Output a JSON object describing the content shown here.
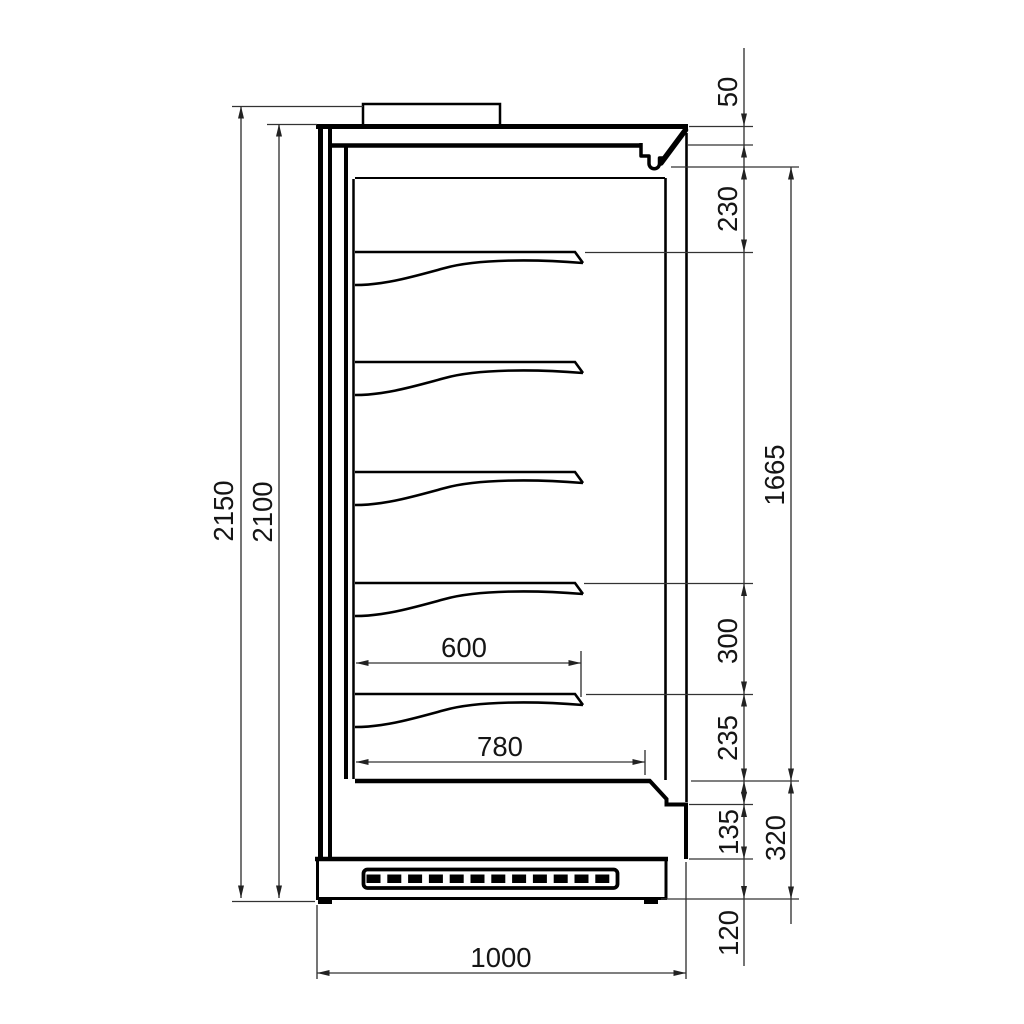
{
  "page": {
    "background": "#ffffff",
    "line_color": "#000000",
    "text_color": "#151515",
    "description": "side-section technical drawing of a multideck display cabinet with five shelves, ventilation grille base and dimension chains"
  },
  "dimensions": {
    "overall_height_with_top_unit": "2150",
    "cabinet_height": "2100",
    "canopy_front_height": "50",
    "canopy_to_first_shelf": "230",
    "opening_height": "1665",
    "shelf_spacing": "300",
    "last_shelf_to_floor": "235",
    "front_panel_height": "135",
    "base_section_height": "320",
    "plinth_height": "120",
    "shelf_depth": "600",
    "bottom_shelf_depth": "780",
    "overall_depth": "1000"
  }
}
